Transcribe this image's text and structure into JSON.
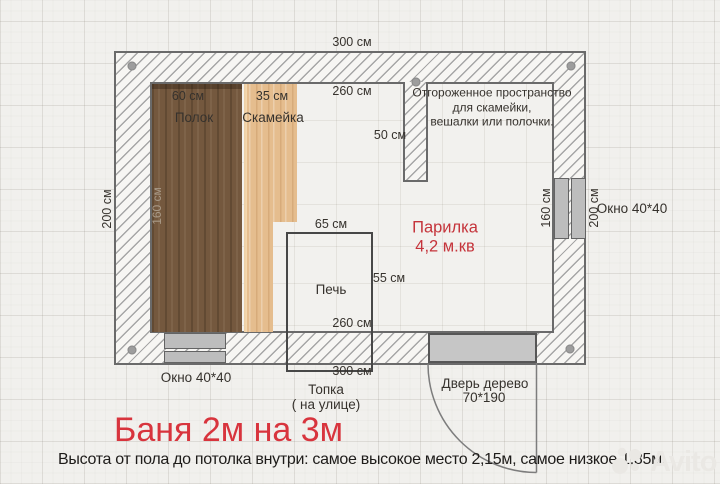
{
  "colors": {
    "accent_red": "#d8343d",
    "label_red": "#c5343b",
    "wood_dark": "#74583e",
    "wood_light": "#e5bd8e",
    "window_gray": "#bdbdbd"
  },
  "dimensions": {
    "outer_width_top": "300 см",
    "inner_width_top": "260 см",
    "outer_height_left": "200 см",
    "polok_width": "60 см",
    "polok_length": "160 см",
    "bench_width": "35 см",
    "partition_depth": "50 см",
    "stove_width": "65 см",
    "stove_depth": "55 см",
    "inner_width_bottom": "260 см",
    "outer_width_bottom": "300 см",
    "window_right_inner_offset": "160 см",
    "window_right_outer_offset": "200 см"
  },
  "labels": {
    "polok": "Полок",
    "bench": "Скамейка",
    "stove": "Печь",
    "room_name": "Парилка",
    "room_area": "4,2 м.кв",
    "niche_note_line1": "Отгороженное пространство",
    "niche_note_line2": "для скамейки,",
    "niche_note_line3": "вешалки или полочки.",
    "window_right": "Окно 40*40",
    "window_bottom": "Окно 40*40",
    "furnace_line1": "Топка",
    "furnace_line2": "( на улице)",
    "door_line1": "Дверь дерево",
    "door_line2": "70*190"
  },
  "title": "Баня 2м на 3м",
  "footnote": "Высота от пола до потолка внутри: самое высокое место 2,15м, самое низкое 1,85м.",
  "watermark": "Avito"
}
